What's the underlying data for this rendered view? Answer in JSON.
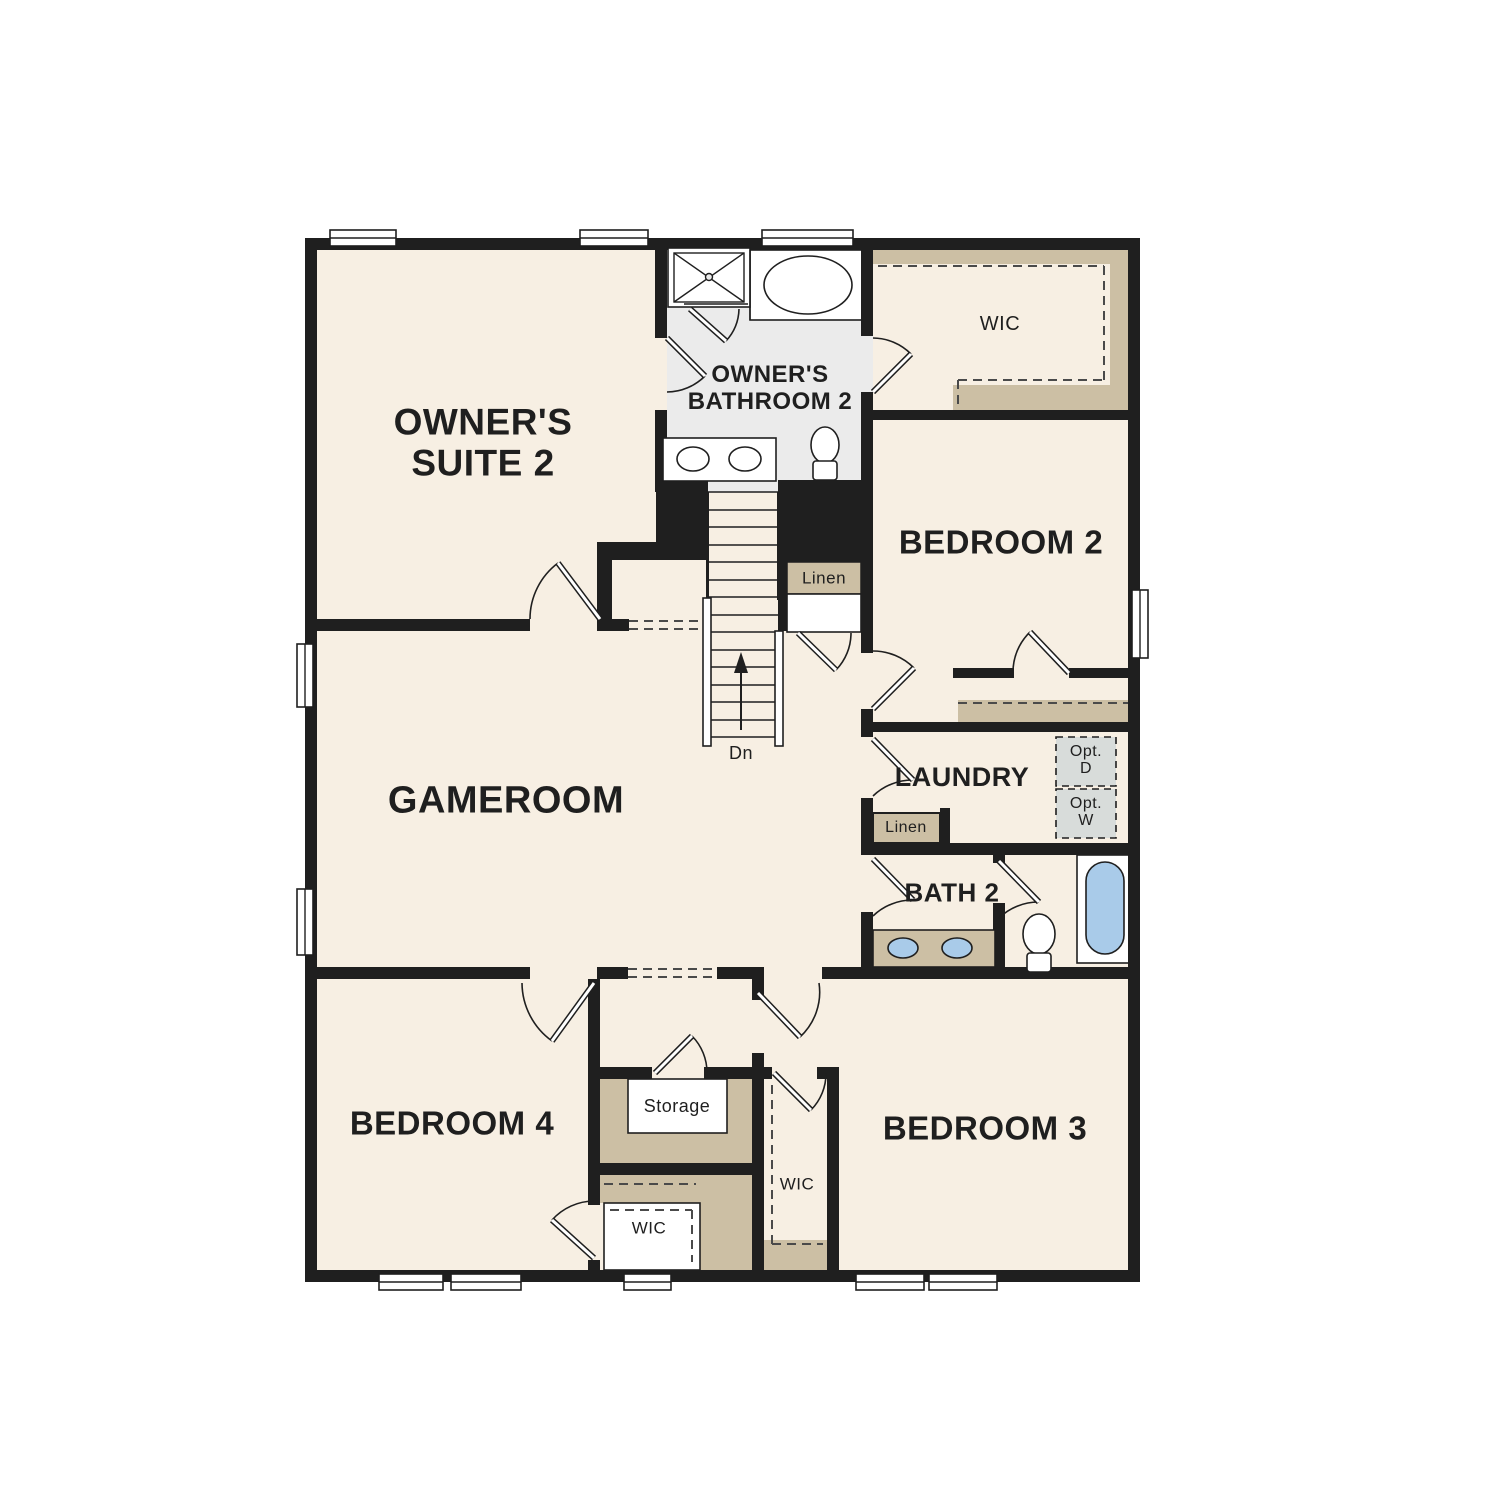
{
  "colors": {
    "floor_cream": "#f7efe3",
    "bathroom_floor_gray": "#ebebeb",
    "shelf_tan": "#ccbfa4",
    "wall_black": "#1f1f1f",
    "fixture_blue": "#a9cbe9",
    "optional_appliance_gray": "#d8dcda",
    "background": "#ffffff"
  },
  "labels": {
    "owners_suite": {
      "text": "OWNER'S\nSUITE 2"
    },
    "owners_bathroom": {
      "text": "OWNER'S\nBATHROOM 2"
    },
    "wic_master": {
      "text": "WIC"
    },
    "bedroom2": {
      "text": "BEDROOM 2"
    },
    "linen_upper": {
      "text": "Linen"
    },
    "gameroom": {
      "text": "GAMEROOM"
    },
    "laundry": {
      "text": "LAUNDRY"
    },
    "opt_dryer": {
      "text": "Opt.\nD"
    },
    "opt_washer": {
      "text": "Opt.\nW"
    },
    "linen_lower": {
      "text": "Linen"
    },
    "bath2": {
      "text": "BATH 2"
    },
    "stairs_down": {
      "text": "Dn"
    },
    "bedroom4": {
      "text": "BEDROOM 4"
    },
    "storage": {
      "text": "Storage"
    },
    "wic_bedroom4": {
      "text": "WIC"
    },
    "wic_bedroom3": {
      "text": "WIC"
    },
    "bedroom3": {
      "text": "BEDROOM 3"
    }
  }
}
